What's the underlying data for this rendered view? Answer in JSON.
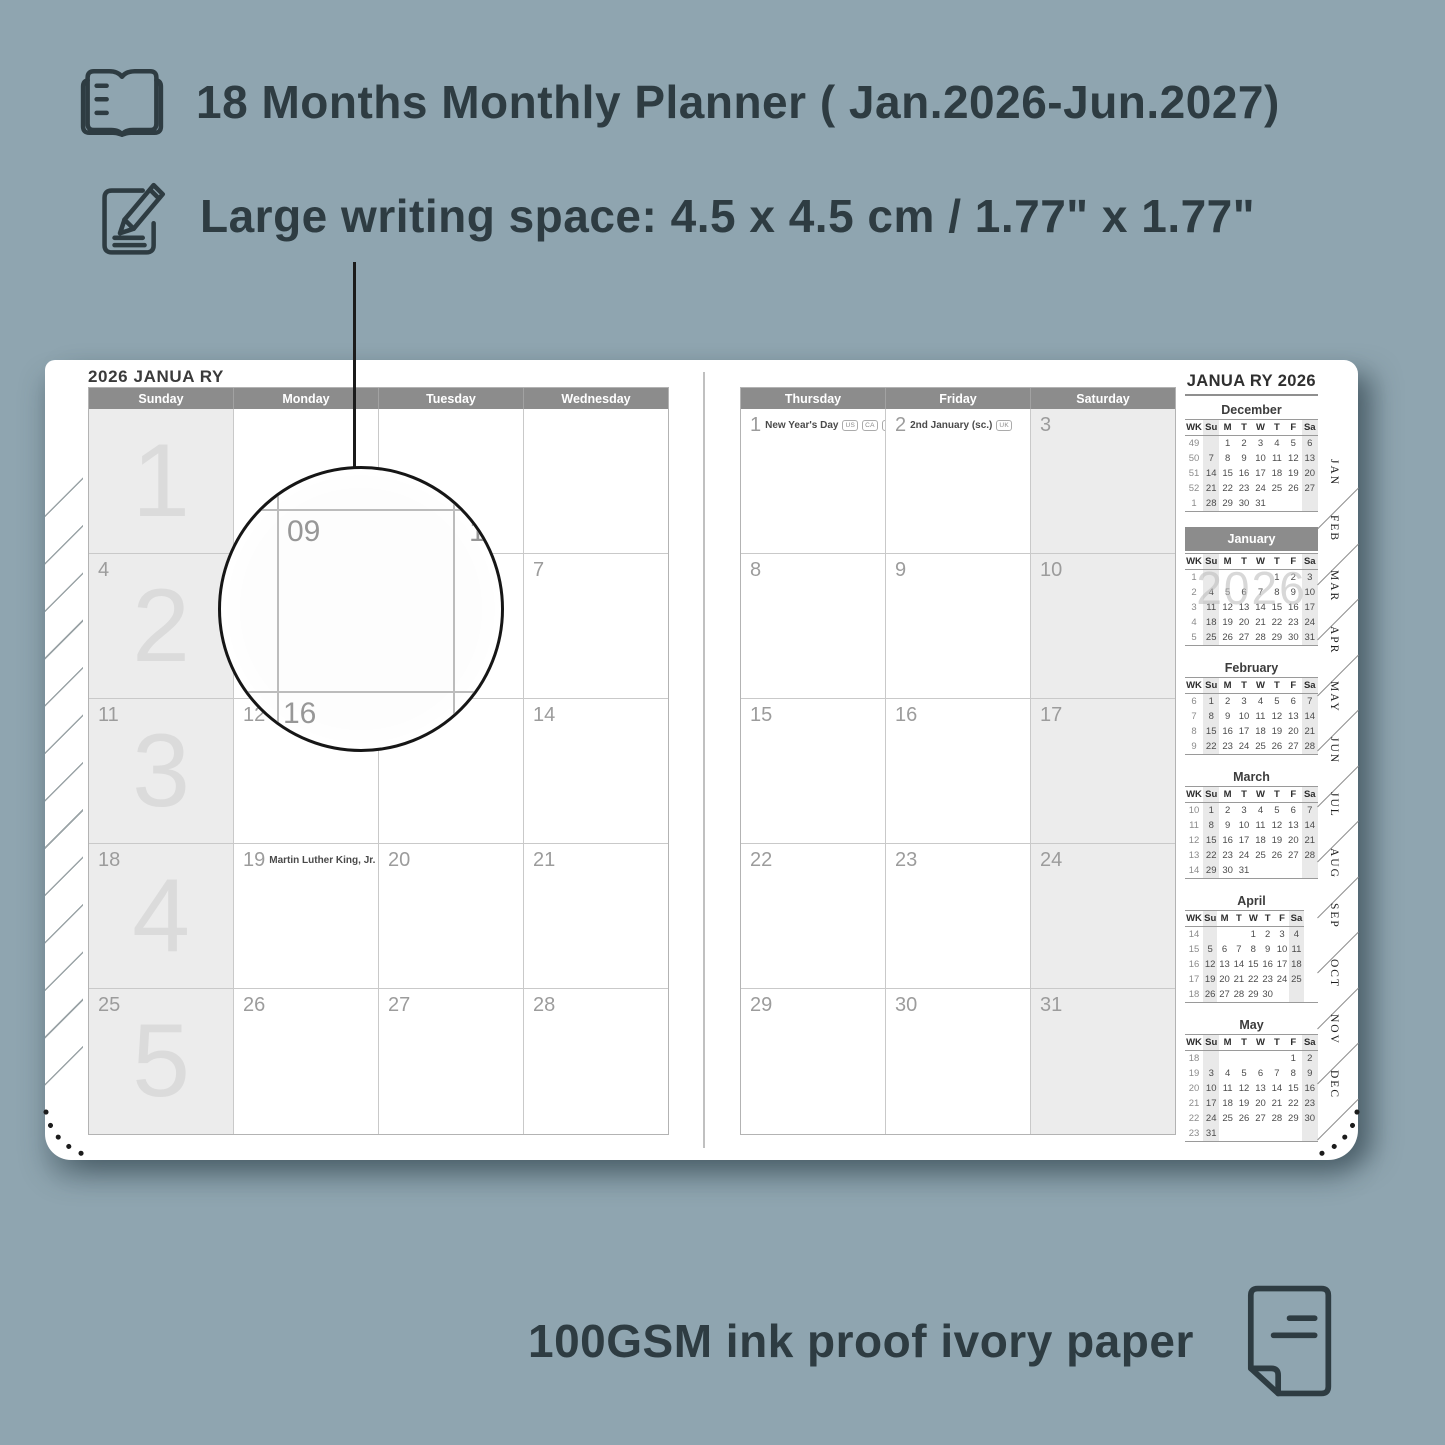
{
  "colors": {
    "background": "#8fa5b0",
    "ink": "#2e3c42",
    "header_bar": "#8c8c8c",
    "cell_shade": "#ececec",
    "line_dark": "#1b1b1b"
  },
  "features": {
    "monthly_planner": {
      "icon": "open-book-icon",
      "text": "18 Months Monthly Planner ( Jan.2026-Jun.2027)"
    },
    "writing_space": {
      "icon": "pencil-note-icon",
      "text": "Large writing space: 4.5 x 4.5 cm / 1.77\" x 1.77\""
    },
    "paper": {
      "icon": "paper-icon",
      "text": "100GSM ink proof ivory paper"
    }
  },
  "planner": {
    "left_page": {
      "title": "2026 JANUA RY",
      "day_headers": [
        "Sunday",
        "Monday",
        "Tuesday",
        "Wednesday"
      ],
      "week_watermarks": [
        "1",
        "2",
        "3",
        "4",
        "5"
      ],
      "weeks": [
        [
          {
            "date": ""
          },
          {
            "date": ""
          },
          {
            "date": ""
          },
          {
            "date": ""
          }
        ],
        [
          {
            "date": "4"
          },
          {
            "date": "5"
          },
          {
            "date": "6"
          },
          {
            "date": "7"
          }
        ],
        [
          {
            "date": "11"
          },
          {
            "date": "12"
          },
          {
            "date": "13"
          },
          {
            "date": "14"
          }
        ],
        [
          {
            "date": "18"
          },
          {
            "date": "19",
            "holiday": "Martin Luther King, Jr. Day",
            "badges": [
              "US"
            ]
          },
          {
            "date": "20"
          },
          {
            "date": "21"
          }
        ],
        [
          {
            "date": "25"
          },
          {
            "date": "26"
          },
          {
            "date": "27"
          },
          {
            "date": "28"
          }
        ]
      ]
    },
    "right_page": {
      "day_headers": [
        "Thursday",
        "Friday",
        "Saturday"
      ],
      "weeks": [
        [
          {
            "date": "1",
            "holiday": "New Year's Day",
            "badges": [
              "US",
              "CA",
              "UK",
              "IE"
            ]
          },
          {
            "date": "2",
            "holiday": "2nd January (sc.)",
            "badges": [
              "UK"
            ]
          },
          {
            "date": "3"
          }
        ],
        [
          {
            "date": "8"
          },
          {
            "date": "9"
          },
          {
            "date": "10"
          }
        ],
        [
          {
            "date": "15"
          },
          {
            "date": "16"
          },
          {
            "date": "17"
          }
        ],
        [
          {
            "date": "22"
          },
          {
            "date": "23"
          },
          {
            "date": "24"
          }
        ],
        [
          {
            "date": "29"
          },
          {
            "date": "30"
          },
          {
            "date": "31"
          }
        ]
      ]
    },
    "sidebar": {
      "title": "JANUA RY 2026",
      "dow": [
        "WK",
        "Su",
        "M",
        "T",
        "W",
        "T",
        "F",
        "Sa"
      ],
      "months": [
        {
          "name": "December",
          "rows": [
            [
              "49",
              "",
              "1",
              "2",
              "3",
              "4",
              "5",
              "6"
            ],
            [
              "50",
              "7",
              "8",
              "9",
              "10",
              "11",
              "12",
              "13"
            ],
            [
              "51",
              "14",
              "15",
              "16",
              "17",
              "18",
              "19",
              "20"
            ],
            [
              "52",
              "21",
              "22",
              "23",
              "24",
              "25",
              "26",
              "27"
            ],
            [
              "1",
              "28",
              "29",
              "30",
              "31",
              "",
              "",
              ""
            ]
          ]
        },
        {
          "name": "January",
          "highlight": true,
          "watermark": "2026",
          "rows": [
            [
              "1",
              "",
              "",
              "",
              "",
              "1",
              "2",
              "3"
            ],
            [
              "2",
              "4",
              "5",
              "6",
              "7",
              "8",
              "9",
              "10"
            ],
            [
              "3",
              "11",
              "12",
              "13",
              "14",
              "15",
              "16",
              "17"
            ],
            [
              "4",
              "18",
              "19",
              "20",
              "21",
              "22",
              "23",
              "24"
            ],
            [
              "5",
              "25",
              "26",
              "27",
              "28",
              "29",
              "30",
              "31"
            ]
          ]
        },
        {
          "name": "February",
          "rows": [
            [
              "6",
              "1",
              "2",
              "3",
              "4",
              "5",
              "6",
              "7"
            ],
            [
              "7",
              "8",
              "9",
              "10",
              "11",
              "12",
              "13",
              "14"
            ],
            [
              "8",
              "15",
              "16",
              "17",
              "18",
              "19",
              "20",
              "21"
            ],
            [
              "9",
              "22",
              "23",
              "24",
              "25",
              "26",
              "27",
              "28"
            ]
          ]
        },
        {
          "name": "March",
          "rows": [
            [
              "10",
              "1",
              "2",
              "3",
              "4",
              "5",
              "6",
              "7"
            ],
            [
              "11",
              "8",
              "9",
              "10",
              "11",
              "12",
              "13",
              "14"
            ],
            [
              "12",
              "15",
              "16",
              "17",
              "18",
              "19",
              "20",
              "21"
            ],
            [
              "13",
              "22",
              "23",
              "24",
              "25",
              "26",
              "27",
              "28"
            ],
            [
              "14",
              "29",
              "30",
              "31",
              "",
              "",
              "",
              ""
            ]
          ]
        },
        {
          "name": "April",
          "rows": [
            [
              "14",
              "",
              "",
              "",
              "1",
              "2",
              "3",
              "4"
            ],
            [
              "15",
              "5",
              "6",
              "7",
              "8",
              "9",
              "10",
              "11"
            ],
            [
              "16",
              "12",
              "13",
              "14",
              "15",
              "16",
              "17",
              "18"
            ],
            [
              "17",
              "19",
              "20",
              "21",
              "22",
              "23",
              "24",
              "25"
            ],
            [
              "18",
              "26",
              "27",
              "28",
              "29",
              "30",
              "",
              "",
              ""
            ]
          ]
        },
        {
          "name": "May",
          "rows": [
            [
              "18",
              "",
              "",
              "",
              "",
              "",
              "1",
              "2"
            ],
            [
              "19",
              "3",
              "4",
              "5",
              "6",
              "7",
              "8",
              "9"
            ],
            [
              "20",
              "10",
              "11",
              "12",
              "13",
              "14",
              "15",
              "16"
            ],
            [
              "21",
              "17",
              "18",
              "19",
              "20",
              "21",
              "22",
              "23"
            ],
            [
              "22",
              "24",
              "25",
              "26",
              "27",
              "28",
              "29",
              "30"
            ],
            [
              "23",
              "31",
              "",
              "",
              "",
              "",
              "",
              ""
            ]
          ]
        }
      ]
    },
    "tabs": [
      "JAN",
      "FEB",
      "MAR",
      "APR",
      "MAY",
      "JUN",
      "JUL",
      "AUG",
      "SEP",
      "OCT",
      "NOV",
      "DEC"
    ],
    "magnifier": {
      "cell_date": "09",
      "right_date": "10",
      "below_date": "16"
    }
  }
}
